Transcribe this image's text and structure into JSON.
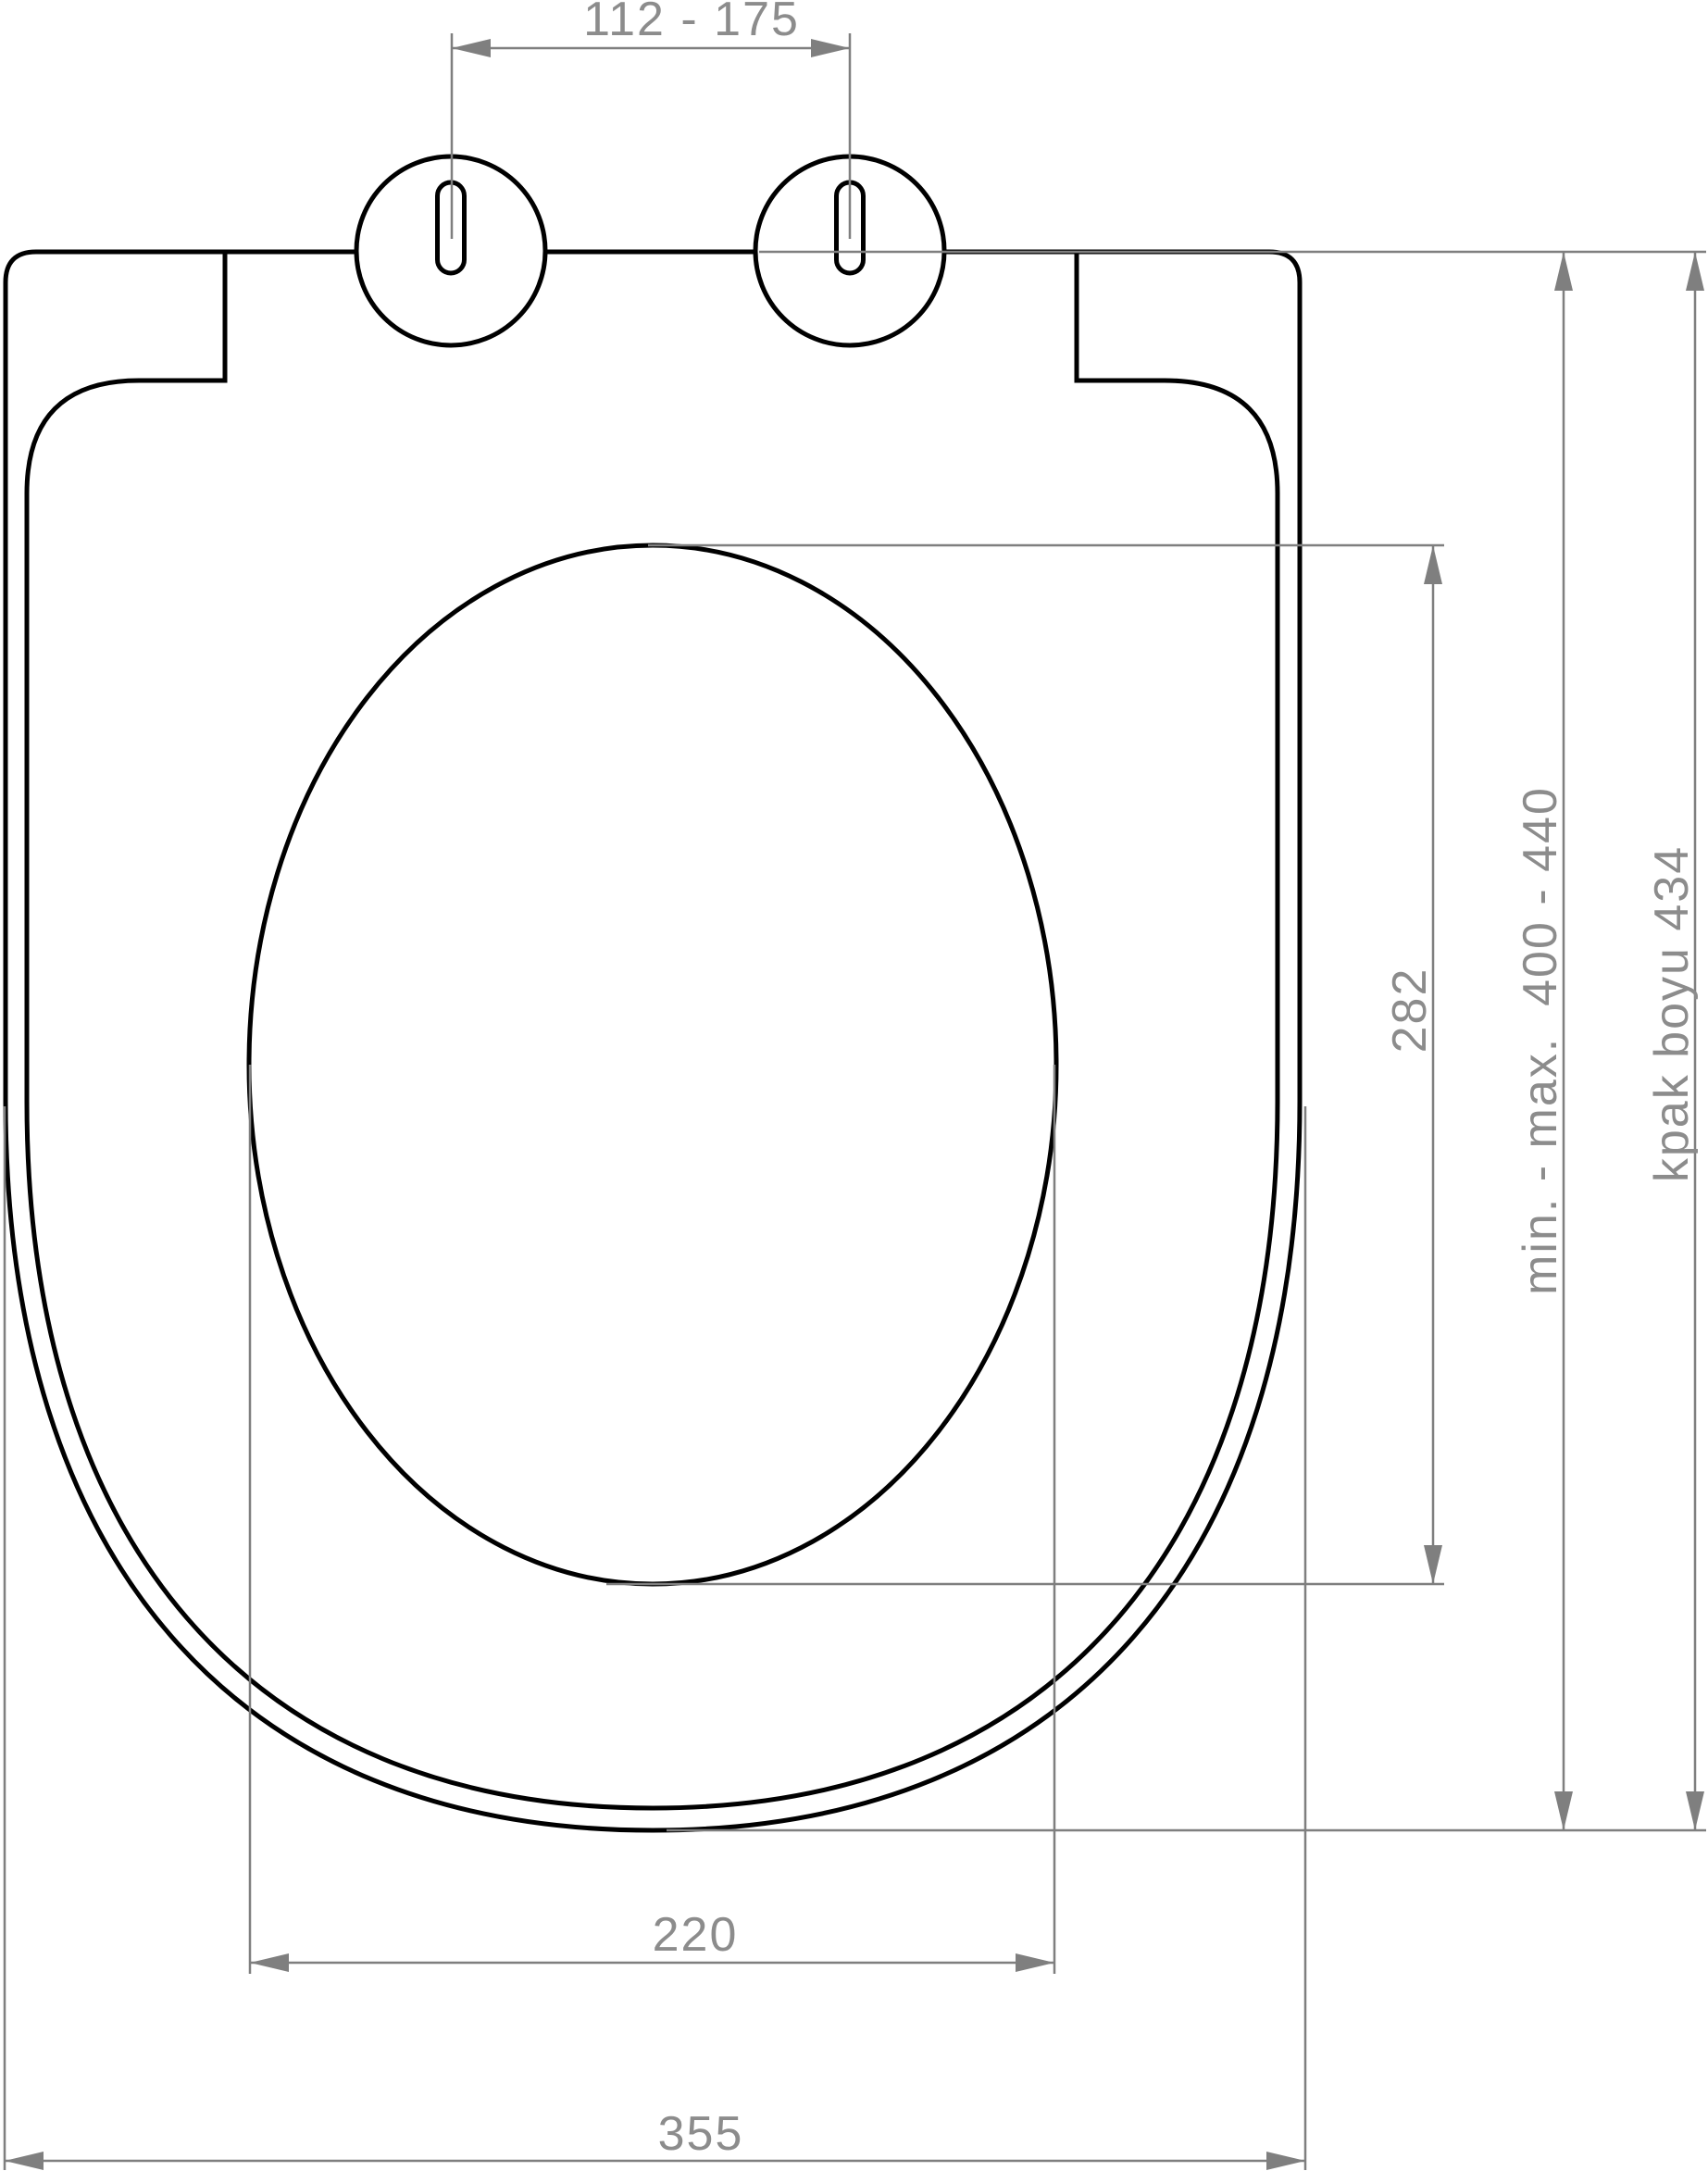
{
  "drawing": {
    "background": "#ffffff",
    "outline_color": "#000000",
    "dimension_color": "#7f7f7f",
    "text_color": "#8c8c8c"
  },
  "dimensions": {
    "hinge_spacing": "112 - 175",
    "opening_height": "282",
    "mounting_range": "min. - max.  400 - 440",
    "cover_length": "kpak boyu 434",
    "opening_width": "220",
    "seat_width": "355"
  }
}
